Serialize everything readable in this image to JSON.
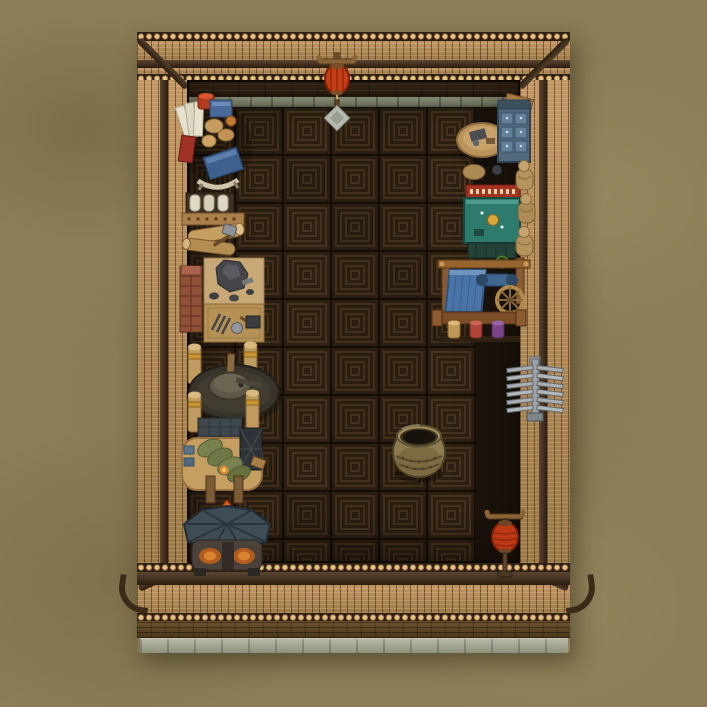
{
  "scene": {
    "genre": "top-down pixel-art building game",
    "room": "Walled courtyard workshop interior",
    "ground_color": "#8b7d55",
    "visible_text": ""
  },
  "palette": {
    "roof_tile": "#b8905a",
    "ridge_beam": "#493524",
    "plank_wall": "#3e2c19",
    "stone_ledge": "#8b8f78",
    "floor_tile": "#2a1e11",
    "floor_pattern_line": "#42301b",
    "brick_base": "#5f4527",
    "stone_path": "#a2a693",
    "lantern_red": "#c23b16",
    "cloth_blue": "#4a74a8",
    "flame_orange": "#e05a1c",
    "sack_green": "#6f7848",
    "furnace_slate": "#3e4c56"
  },
  "floor": {
    "cols": 7,
    "rows": 10,
    "tile_size": 48,
    "rings": 4
  },
  "environment": {
    "roof": {
      "label": "Tiled roof wall ring"
    },
    "plank": {
      "label": "Dark plank back wall"
    },
    "ledge": {
      "label": "Stone ledge"
    },
    "floor": {
      "label": "Dark patterned parquet floor"
    },
    "path": {
      "label": "Stone foundation path"
    },
    "ground": {
      "label": "Dirt ground"
    }
  },
  "objects": [
    {
      "id": "scribe-desk",
      "label": "Scribe desk with blue books, scrolls and red jar"
    },
    {
      "id": "lumber-rack",
      "label": "Lumber rack with logs and hatchet"
    },
    {
      "id": "stonecutting-table",
      "label": "Stonecutting table with boulder, chisels and brick stack"
    },
    {
      "id": "millstone",
      "label": "Stone mill on platform with four wooden posts"
    },
    {
      "id": "processing-bench",
      "label": "Processing bench with green grain sacks and hopper"
    },
    {
      "id": "smelting-furnace",
      "label": "Slate-roofed smelting furnace with flame"
    },
    {
      "id": "standing-lantern-top",
      "label": "Standing red lantern on stone base"
    },
    {
      "id": "tool-cabinet-desk",
      "label": "Workbench with drawer cabinet and crate"
    },
    {
      "id": "apothecary-table",
      "label": "Teal apothecary table with red banner"
    },
    {
      "id": "wooden-statues",
      "label": "Wooden practice statues"
    },
    {
      "id": "weaving-loom",
      "label": "Weaving loom with blue cloth and thread spools"
    },
    {
      "id": "weapon-rack",
      "label": "Wall-mounted metal weapon rack"
    },
    {
      "id": "ceramic-vat",
      "label": "Large ceramic storage vat"
    },
    {
      "id": "standing-lantern-bottom",
      "label": "Standing red lantern"
    }
  ]
}
